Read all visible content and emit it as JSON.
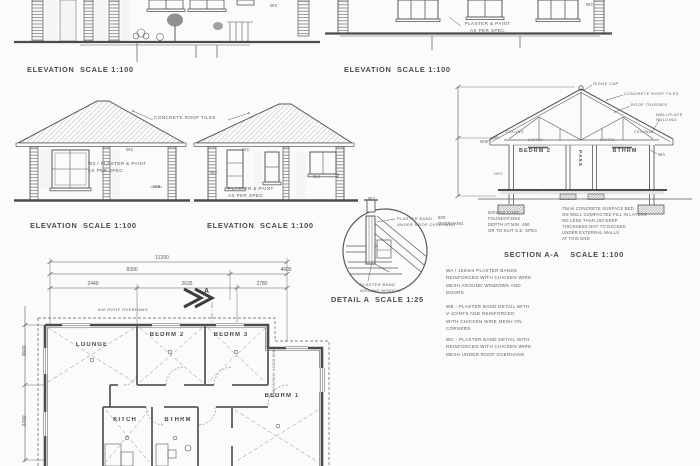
{
  "colors": {
    "ink": "#565656",
    "bg": "#fbfbf9"
  },
  "labels": {
    "elevation": "ELEVATION  SCALE 1:100",
    "section": "SECTION A-A    SCALE 1:100",
    "detail": "DETAIL A  SCALE 1:25"
  },
  "top_left_elevation": {
    "window_mark": "W3"
  },
  "top_right_elevation": {
    "finish_note": "PLASTER & PAINT\nAS PER SPEC",
    "window_mark": "W2"
  },
  "house_elevation_1": {
    "roof_callout": "CONCRETE ROOF TILES",
    "finish_note": "W3 / PLASTER & PAINT\nAS PER SPEC",
    "band_mark_wb": "WB",
    "band_mark_w2": "W2"
  },
  "house_elevation_2": {
    "finish_note": "PLASTER & PAINT\nAS PER SPEC",
    "band_mark_wc": "WC",
    "band_mark_w4": "W4"
  },
  "section_aa": {
    "room_left": "BEDRM 2",
    "room_mid": "PASS",
    "room_right": "BTHRM",
    "ridge_callout": "RIDGE CAP",
    "tiles_callout": "CONCRETE ROOF TILES",
    "trusses_callout": "ROOF TRUSSES",
    "wallplate_callout": "WALLPLATE\nHOLDING",
    "ceiling_label": "CEILING",
    "lintol_label": "LINTOL",
    "dpc_label": "DPC",
    "mark_wc": "WC",
    "mark_wa": "WA",
    "overhang_note": "600\nOVERHANG",
    "foundation_note": "600x250 CONC.\nFOUNDATIONS\nDEPTH AT MIN. 450\nOR TO SUIT S.E. SPEC",
    "surface_bed_note": "75mm CONCRETE SURFACE BED\nON WELL COMPACTED FILL IN LAYERS\nNO LESS THAN 150 DEEP\nTHICKNESS NOT TO EXCEED\nUNDER EXTERNAL WALLS\nAT THIS END"
  },
  "detail_a": {
    "band_mark": "W2",
    "callout_top": "PLASTER BAND\nUNDER ROOF OVERHANG",
    "callout_bottom": "PLASTER BAND\nAROUND WINDOW"
  },
  "notes": {
    "wa": "WA / 150mm PLASTER BANDS\nREINFORCED WITH CHICKEN WIRE\nMESH AROUND WINDOWS AND\nDOORS",
    "wb": "WB - PLASTER BAND DETAIL WITH\nV-JOINTS AND REINFORCED\nWITH CHICKEN WIRE MESH ON\nCORNERS",
    "wc": "WC - PLASTER BAND DETAIL WITH\nREINFORCED WITH CHICKEN WIRE\nMESH UNDER ROOF OVERHANG"
  },
  "floor_plan": {
    "dim_total": "11200",
    "dim_main": "8390",
    "dim_right": "4605",
    "dim_seg_1": "2440",
    "dim_seg_2": "2635",
    "dim_seg_3": "2780",
    "dim_left_upper": "3600",
    "dim_left_lower": "2430",
    "overhang_top": "600 ROOF OVERHANG",
    "overhang_right": "600 ROOF OVERHANG",
    "section_marker": "A",
    "room_lounge": "LOUNGE",
    "room_bed2": "BEDRM 2",
    "room_bed3": "BEDRM 3",
    "room_bed1": "BEDRM 1",
    "room_kitchen": "KITCH",
    "room_bath": "BTHRM"
  }
}
